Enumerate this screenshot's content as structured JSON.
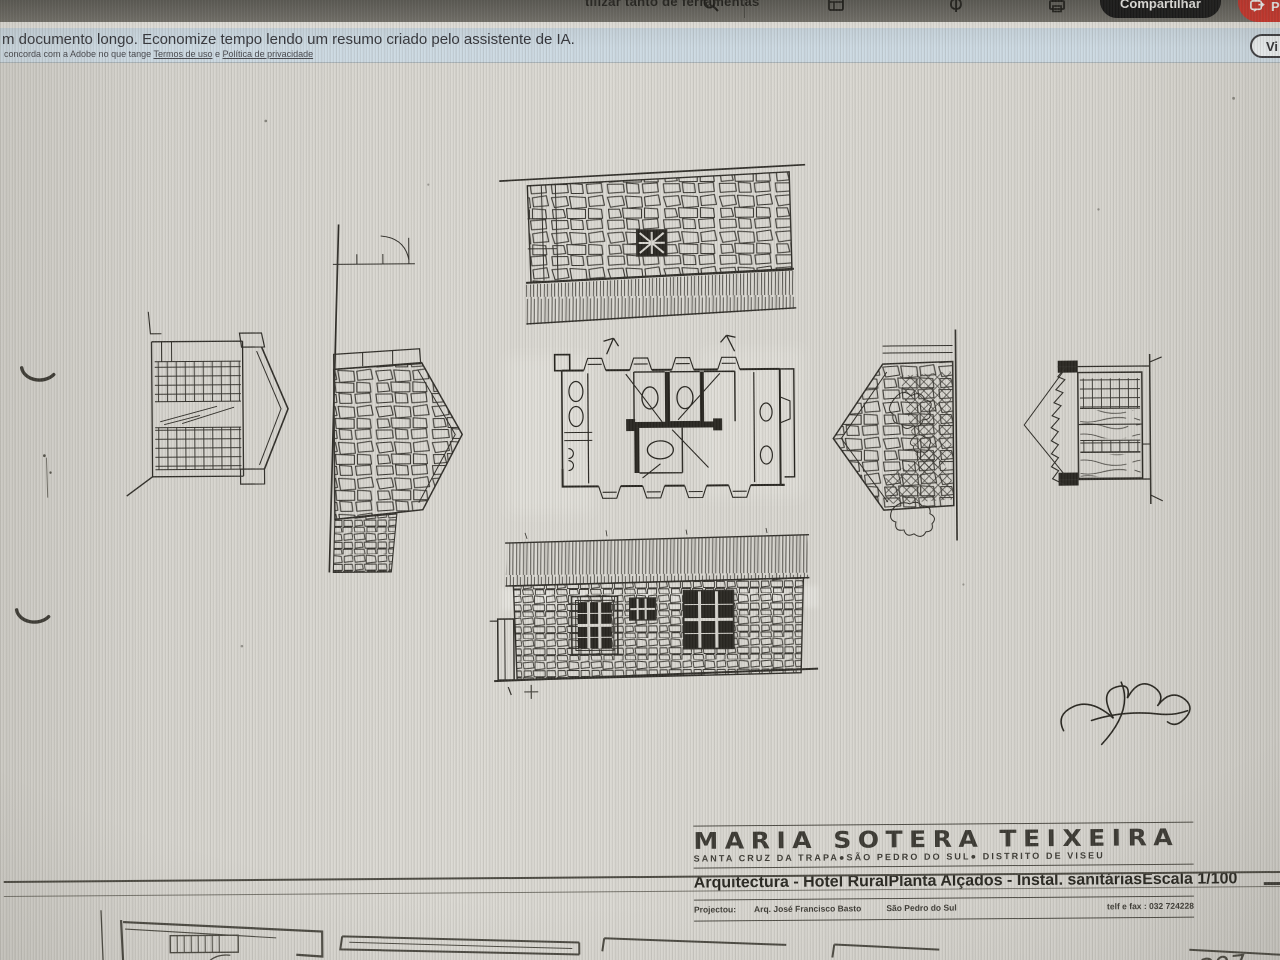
{
  "toolbar": {
    "tools_text": "tilizar tanto de ferramentas",
    "share_label": "Compartilhar",
    "export_hint": "P"
  },
  "banner": {
    "message": "m documento longo. Economize tempo lendo um resumo criado pelo assistente de IA.",
    "disclaimer_prefix": "concorda com a Adobe no que tange",
    "terms_label": "Termos de uso",
    "conjunction": "e",
    "privacy_label": "Política de privacidade",
    "summary_button_label": "Vi"
  },
  "title_block": {
    "name": "MARIA SOTERA TEIXEIRA",
    "location": "SANTA CRUZ DA TRAPA●SÃO PEDRO DO SUL●  DISTRITO DE VISEU",
    "discipline": "Arquitectura - Hotel Rural",
    "drawing_title": "Planta  Alçados - Instal. sanitárias",
    "scale": "Escala  1/100",
    "credit_label": "Projectou:",
    "credit_architect": "Arq. José Francisco Basto",
    "credit_place": "São Pedro do Sul",
    "credit_phone": "telf e fax :  032 724228"
  },
  "page_annotation": "397",
  "colors": {
    "banner_bg": "#cbd9e3",
    "toolbar_bg": "#75736b",
    "share_button_bg": "#161616",
    "export_button_bg": "#dd3126",
    "paper": "#d7d5ce",
    "ink": "#2e2c27"
  }
}
